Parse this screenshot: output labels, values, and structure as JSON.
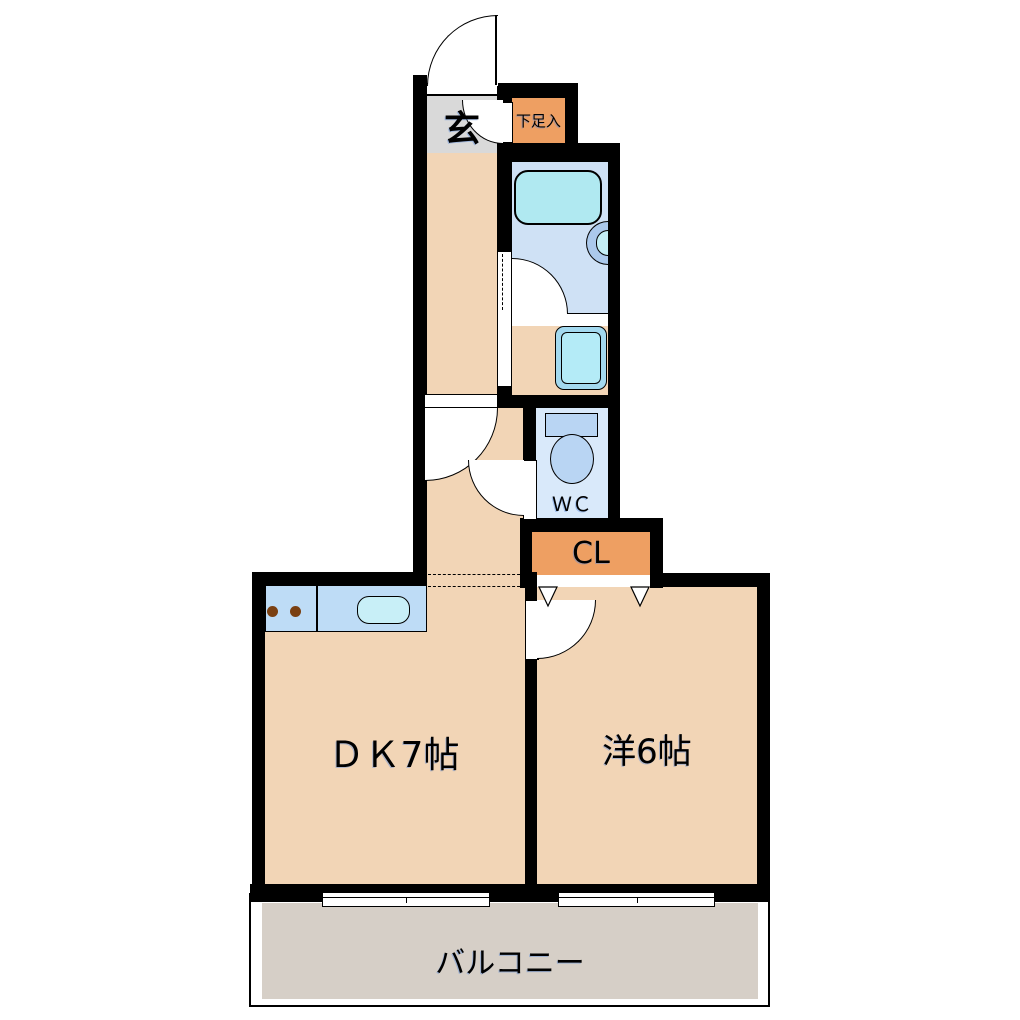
{
  "rooms": {
    "genkan": {
      "label": "玄"
    },
    "shoe_storage": {
      "label": "下足入"
    },
    "wc": {
      "label": "ＷＣ"
    },
    "closet": {
      "label": "CL"
    },
    "dining_kitchen": {
      "label": "ＤＫ7帖"
    },
    "western_room": {
      "label": "洋6帖"
    },
    "balcony": {
      "label": "バルコニー"
    }
  },
  "fixtures": [
    "bathtub",
    "washbasin",
    "washing-machine",
    "toilet",
    "kitchen-counter",
    "gas-burners",
    "kitchen-sink",
    "sliding-windows",
    "folding-closet-door",
    "door-swing-arcs"
  ],
  "colors": {
    "wall": "#000000",
    "room_floor": "#f2d5b6",
    "genkan_floor": "#d9d9d9",
    "storage_orange": "#ee9f62",
    "bath_floor": "#cfe1f5",
    "bathtub": "#b0e9f1",
    "wc_floor": "#d9e9fa",
    "fixture_blue": "#b9d5f3",
    "basin_rim": "#abc9ec",
    "basin_bowl": "#c4eef6",
    "washer_rim": "#a3d9ef",
    "washer_tub": "#b4ebf7",
    "counter": "#bedcf6",
    "sink": "#c8eff7",
    "burner": "#7a4012",
    "balcony_floor": "#d6cfc7"
  }
}
